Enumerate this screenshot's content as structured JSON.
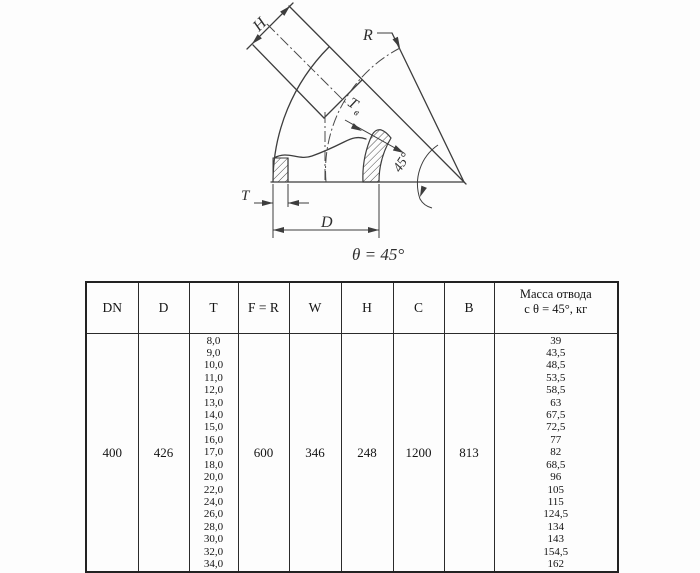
{
  "drawing": {
    "labels": {
      "h": "H",
      "r": "R",
      "t": "T",
      "d": "D",
      "tb_main": "T",
      "tb_sub": "в",
      "angle45": "45°",
      "theta": "θ = 45°"
    }
  },
  "table": {
    "headers": [
      "DN",
      "D",
      "T",
      "F = R",
      "W",
      "H",
      "C",
      "B"
    ],
    "mass_header_line1": "Масса отвода",
    "mass_header_line2": "с θ = 45°, кг",
    "row": {
      "dn": "400",
      "d": "426",
      "t_values": [
        "8,0",
        "9,0",
        "10,0",
        "11,0",
        "12,0",
        "13,0",
        "14,0",
        "15,0",
        "16,0",
        "17,0",
        "18,0",
        "20,0",
        "22,0",
        "24,0",
        "26,0",
        "28,0",
        "30,0",
        "32,0",
        "34,0"
      ],
      "f_r": "600",
      "w": "346",
      "h": "248",
      "c": "1200",
      "b": "813",
      "mass_values": [
        "39",
        "43,5",
        "48,5",
        "53,5",
        "58,5",
        "63",
        "67,5",
        "72,5",
        "77",
        "82",
        "68,5",
        "96",
        "105",
        "115",
        "124,5",
        "134",
        "143",
        "154,5",
        "162"
      ]
    }
  },
  "colors": {
    "line": "#3d3d3d",
    "text": "#1c1c1c"
  }
}
